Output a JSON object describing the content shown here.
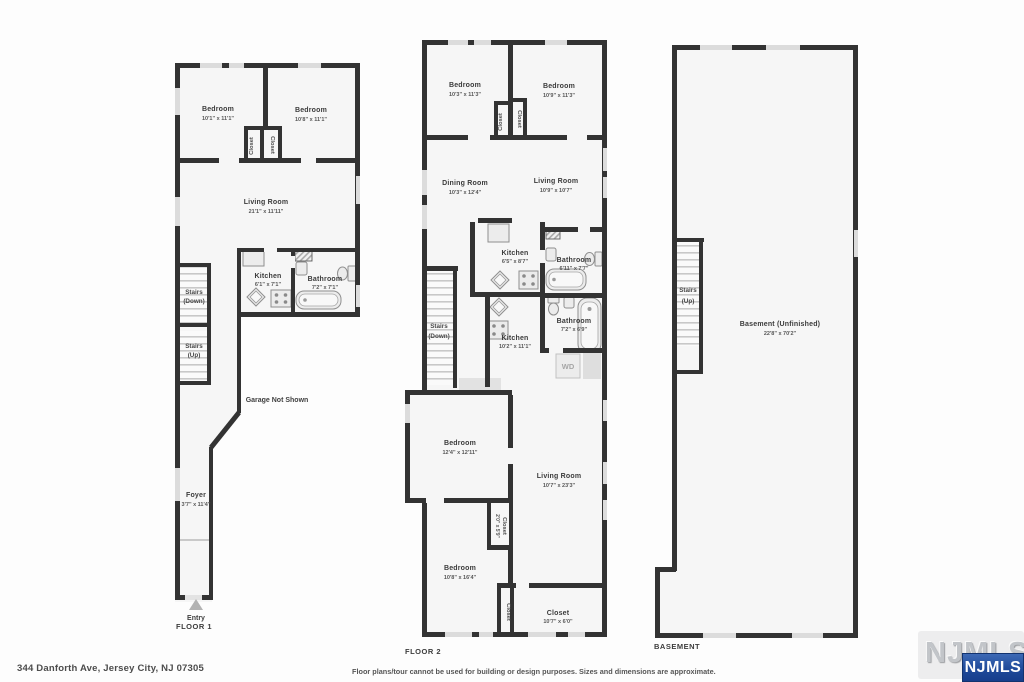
{
  "floor1": {
    "title": "FLOOR 1",
    "bedroom1": {
      "name": "Bedroom",
      "dims": "10'1\" x 11'1\""
    },
    "bedroom2": {
      "name": "Bedroom",
      "dims": "10'8\" x 11'1\""
    },
    "closet1": {
      "name": "Closet"
    },
    "closet2": {
      "name": "Closet"
    },
    "living": {
      "name": "Living Room",
      "dims": "21'1\" x 11'11\""
    },
    "kitchen": {
      "name": "Kitchen",
      "dims": "6'1\" x 7'1\""
    },
    "bathroom": {
      "name": "Bathroom",
      "dims": "7'2\" x 7'1\""
    },
    "stairs_down_l1": "Stairs",
    "stairs_down_l2": "(Down)",
    "stairs_up_l1": "Stairs",
    "stairs_up_l2": "(Up)",
    "garage_note": "Garage Not Shown",
    "foyer": {
      "name": "Foyer",
      "dims": "3'7\" x 11'4\""
    },
    "entry_label": "Entry"
  },
  "floor2": {
    "title": "FLOOR 2",
    "bedroom1": {
      "name": "Bedroom",
      "dims": "10'3\" x 11'3\""
    },
    "bedroom2": {
      "name": "Bedroom",
      "dims": "10'9\" x 11'3\""
    },
    "closet1": {
      "name": "Closet"
    },
    "closet2": {
      "name": "Closet"
    },
    "dining": {
      "name": "Dining Room",
      "dims": "10'3\" x 12'4\""
    },
    "living_upper": {
      "name": "Living Room",
      "dims": "10'9\" x 10'7\""
    },
    "kitchen_upper": {
      "name": "Kitchen",
      "dims": "6'5\" x 8'7\""
    },
    "bathroom_upper": {
      "name": "Bathroom",
      "dims": "6'11\" x 7'7\""
    },
    "stairs_l1": "Stairs",
    "stairs_l2": "(Down)",
    "kitchen_lower": {
      "name": "Kitchen",
      "dims": "10'2\" x 11'1\""
    },
    "bathroom_lower": {
      "name": "Bathroom",
      "dims": "7'2\" x 6'9\""
    },
    "wd_label": "WD",
    "bedroom3": {
      "name": "Bedroom",
      "dims": "12'4\" x 12'11\""
    },
    "living_lower": {
      "name": "Living Room",
      "dims": "10'7\" x 23'3\""
    },
    "closet3": {
      "name": "Closet",
      "dims": "2'0\" x 5'9\""
    },
    "bedroom4": {
      "name": "Bedroom",
      "dims": "10'8\" x 16'4\""
    },
    "closet4": {
      "name": "Closet"
    },
    "closet5": {
      "name": "Closet",
      "dims": "10'7\" x 6'0\""
    }
  },
  "basement": {
    "title": "BASEMENT",
    "stairs_l1": "Stairs",
    "stairs_l2": "(Up)",
    "room": {
      "name": "Basement (Unfinished)",
      "dims": "22'8\" x 70'2\""
    }
  },
  "footer": {
    "address": "344 Danforth Ave, Jersey City, NJ 07305",
    "disclaimer": "Floor plans/tour cannot be used for building or design purposes. Sizes and dimensions are approximate.",
    "logo": "NJMLS",
    "logo_watermark": "NJMLS"
  },
  "colors": {
    "wall": "#333333",
    "floor_fill": "#f6f6f6",
    "logo_blue": "#1f4a9a"
  }
}
